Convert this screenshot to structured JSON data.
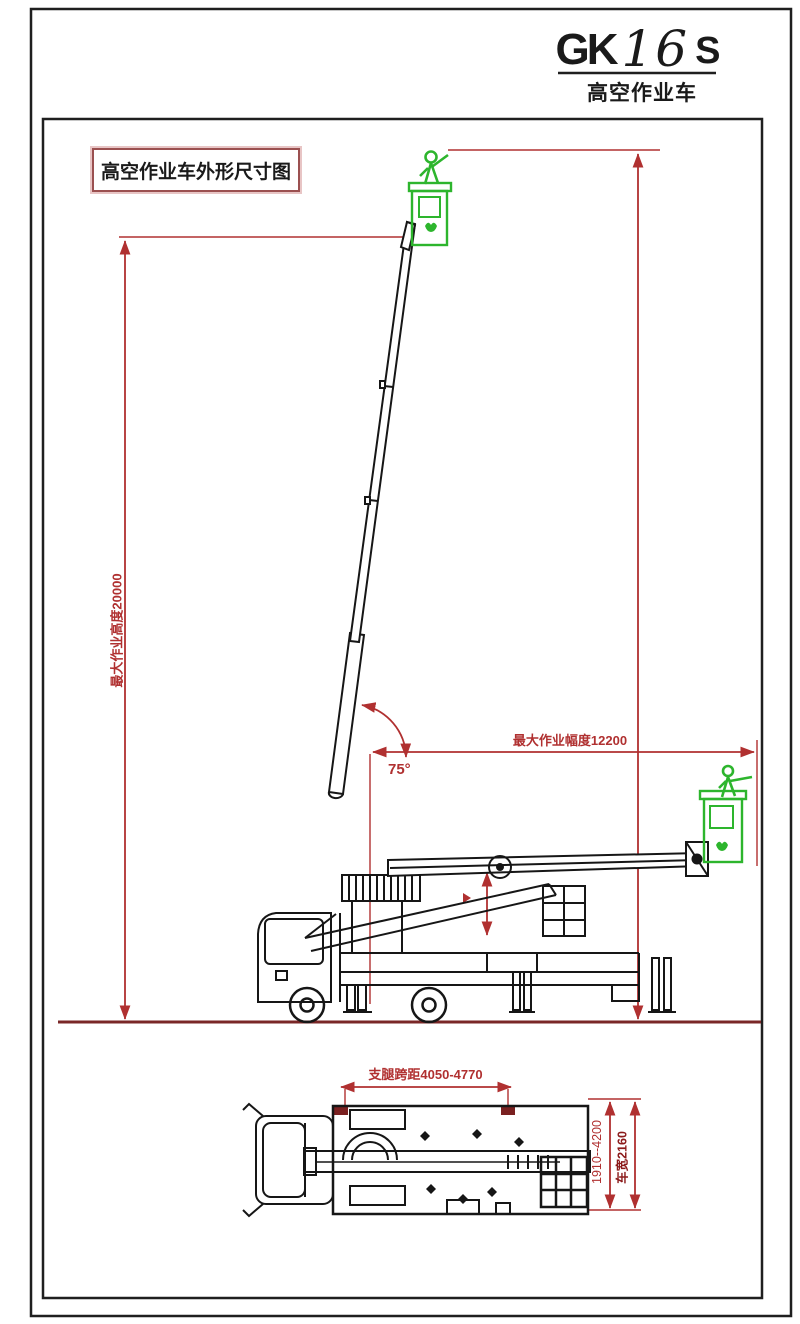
{
  "title": {
    "prefix": "GK",
    "number": "16",
    "suffix": "S",
    "subtitle": "高空作业车"
  },
  "caption": "高空作业车外形尺寸图",
  "dims": {
    "max_height": "最大作业高度20000",
    "max_reach": "最大作业幅度12200",
    "boom_angle": "75°",
    "outrigger_span": "支腿跨距4050-4770",
    "width_range": "1910--4200",
    "vehicle_width": "车宽2160"
  },
  "colors": {
    "dimension_red": "#b03030",
    "dark_red": "#8b1a1a",
    "ground_maroon": "#7a2727",
    "basket_green": "#2db52d",
    "line_black": "#161616"
  }
}
